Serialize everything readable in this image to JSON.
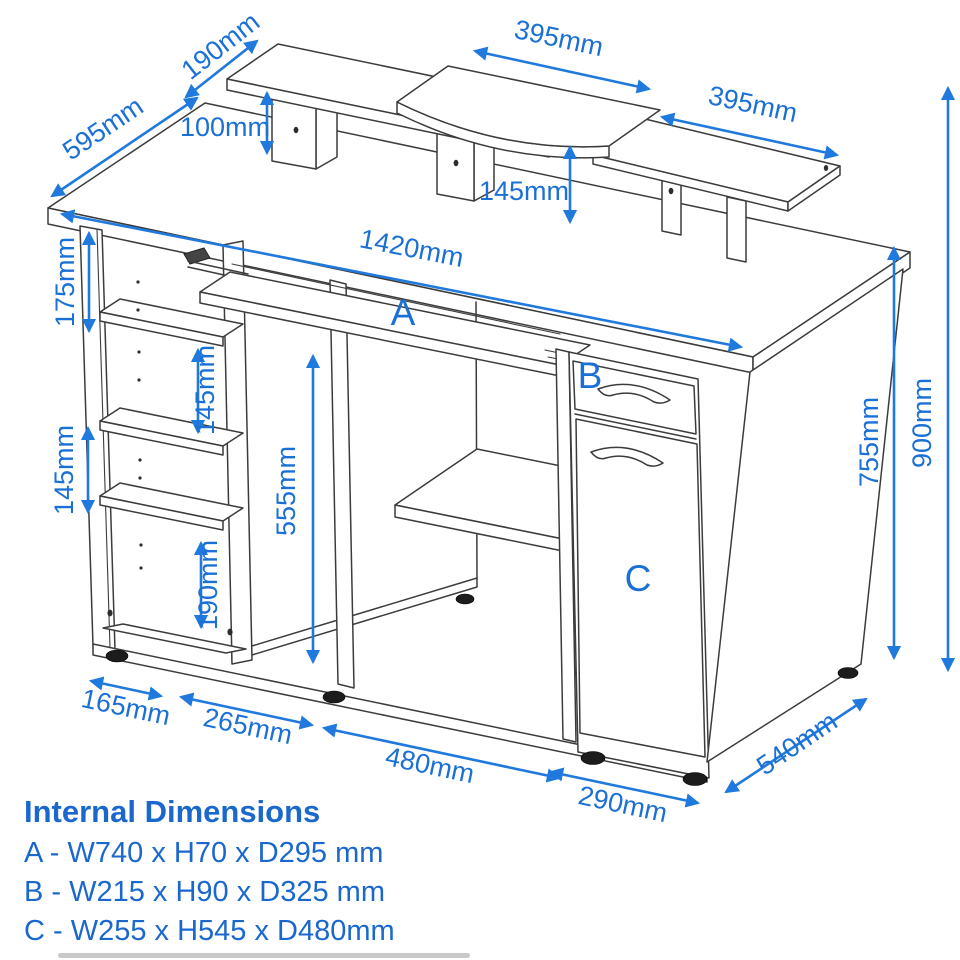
{
  "diagram_title": "Computer desk dimension drawing",
  "colors": {
    "dimension_blue": "#1b70d6",
    "line_dark": "#3c3c3c",
    "background": "#ffffff"
  },
  "labels": {
    "riser_left_depth": "190mm",
    "desk_depth": "595mm",
    "riser_left_height": "100mm",
    "riser_center_width": "395mm",
    "riser_right_width": "395mm",
    "riser_right_height": "145mm",
    "desk_width": "1420mm",
    "shelf_gap_top": "175mm",
    "shelf_gap_mid": "145mm",
    "shelf_gap_left": "145mm",
    "compartment_height": "555mm",
    "base_shelf_height": "190mm",
    "underside_height": "755mm",
    "overall_height": "900mm",
    "left_unit_width": "165mm",
    "center_bay_width": "265mm",
    "kneehole_width": "480mm",
    "pedestal_width": "290mm",
    "pedestal_depth": "540mm",
    "part_a": "A",
    "part_b": "B",
    "part_c": "C"
  },
  "legend": {
    "title": "Internal Dimensions",
    "line_a": "A - W740 x H70 x D295 mm",
    "line_b": "B - W215 x H90 x D325 mm",
    "line_c": "C - W255 x H545 x D480mm"
  }
}
